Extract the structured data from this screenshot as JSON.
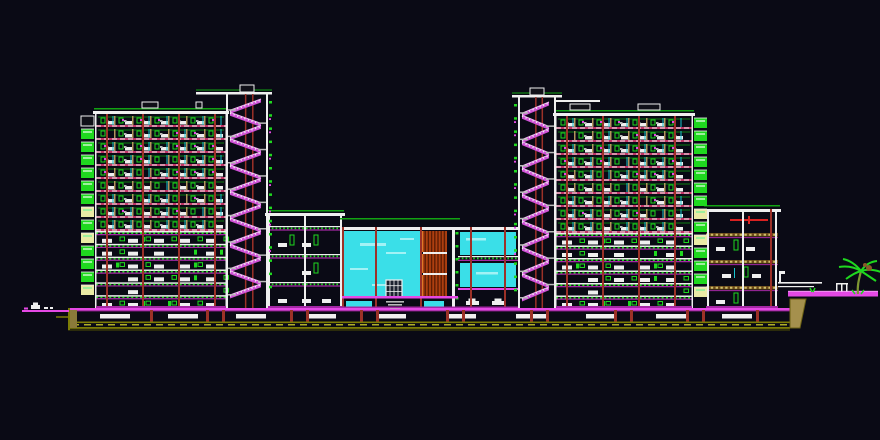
{
  "canvas": {
    "width": 880,
    "height": 440,
    "background": "#0a0a15"
  },
  "palette": {
    "white": "#efefef",
    "gray": "#b9b9b9",
    "green": "#1fd81f",
    "green_dim": "#12a312",
    "magenta": "#e549e5",
    "magenta_dark": "#a428a4",
    "slab_red": "#bf3466",
    "column_red": "#9c3128",
    "red": "#d92121",
    "tan": "#b3955c",
    "khaki": "#cfc06a",
    "cyan": "#3adfe8",
    "cyan_light": "#a2f2f5",
    "cyan_line": "#17c3cf",
    "olive": "#7c7c06",
    "yellow": "#e6e62e",
    "pale_yellow": "#eaeaa6",
    "louver": "#ad3f10",
    "louver_dark": "#5c1d04",
    "louver_light": "#dd7a28",
    "stair": "#cf52d6",
    "stair_light": "#f0b2f2",
    "window_dark": "#1c2330",
    "brown": "#8a5a2a",
    "trunk": "#7e9732",
    "dark_fill": "#101018",
    "soil": "#8a7a3a",
    "wedge": "#a5904d",
    "wedge_edge": "#6b6014"
  },
  "elements": [
    {
      "type": "ground",
      "name": "foundation-strip",
      "x": 68,
      "y": 308,
      "w": 722,
      "slabs": [
        [
          100,
          30
        ],
        [
          168,
          30
        ],
        [
          236,
          30
        ],
        [
          306,
          30
        ],
        [
          376,
          30
        ],
        [
          446,
          30
        ],
        [
          516,
          30
        ],
        [
          586,
          30
        ],
        [
          656,
          30
        ],
        [
          722,
          30
        ]
      ],
      "columns": [
        150,
        206,
        222,
        290,
        306,
        360,
        376,
        446,
        462,
        530,
        546,
        614,
        630,
        686,
        702,
        756
      ]
    },
    {
      "type": "walkway",
      "name": "left-approach-path",
      "x": 22,
      "y": 310,
      "w": 47,
      "h": 2,
      "symbols": true
    },
    {
      "type": "walkway",
      "name": "right-walkway",
      "x": 788,
      "y": 292,
      "w": 90,
      "h": 4.5,
      "bench": true,
      "tuft": true
    },
    {
      "type": "canopy",
      "name": "right-entrance-canopy",
      "x": 778,
      "y": 282
    },
    {
      "type": "midblock",
      "name": "central-low-block",
      "x": 268,
      "y": 208,
      "w": 74,
      "bottom": 308,
      "floor_ys": [
        226,
        254,
        282
      ]
    },
    {
      "type": "atrium",
      "name": "glass-atrium",
      "x": 342,
      "y": 218,
      "w": 116,
      "bottom": 308
    },
    {
      "type": "glassfloors",
      "name": "atrium-east-glass-floors",
      "x": 458,
      "y": 218,
      "w": 60,
      "bottom": 308
    },
    {
      "type": "annex",
      "name": "right-annex",
      "x": 706,
      "y": 205,
      "w": 72,
      "bottom": 308,
      "floor_ys": [
        233,
        260,
        286
      ]
    },
    {
      "type": "tower",
      "name": "left-tower",
      "x": 96,
      "y": 108,
      "w": 130,
      "bottom": 308,
      "floor_h": 13,
      "upper_floors": 9,
      "lower_floors": 6,
      "balcony": "left",
      "dark_first": true,
      "roof_blocks": [
        [
          46,
          16
        ],
        [
          100,
          6
        ]
      ]
    },
    {
      "type": "tower",
      "name": "right-tower",
      "x": 556,
      "y": 110,
      "w": 136,
      "bottom": 308,
      "floor_h": 13,
      "upper_floors": 9,
      "lower_floors": 6,
      "balcony": "right",
      "roof_blocks": [
        [
          14,
          20
        ],
        [
          82,
          22
        ]
      ],
      "roof_line2": [
        556,
        100,
        44
      ]
    },
    {
      "type": "shaft",
      "name": "left-stair-shaft",
      "x": 226,
      "y": 92,
      "w": 42,
      "bottom": 308,
      "floor_h": 13.2,
      "roof_x": 196,
      "roof_w": 76,
      "ticks": "right"
    },
    {
      "type": "shaft",
      "name": "right-stair-shaft",
      "x": 518,
      "y": 95,
      "w": 38,
      "bottom": 308,
      "floor_h": 13.2,
      "roof_x": 512,
      "roof_w": 50,
      "ticks": "left"
    },
    {
      "type": "palm",
      "name": "palm-tree",
      "x": 858,
      "y": 294
    }
  ]
}
